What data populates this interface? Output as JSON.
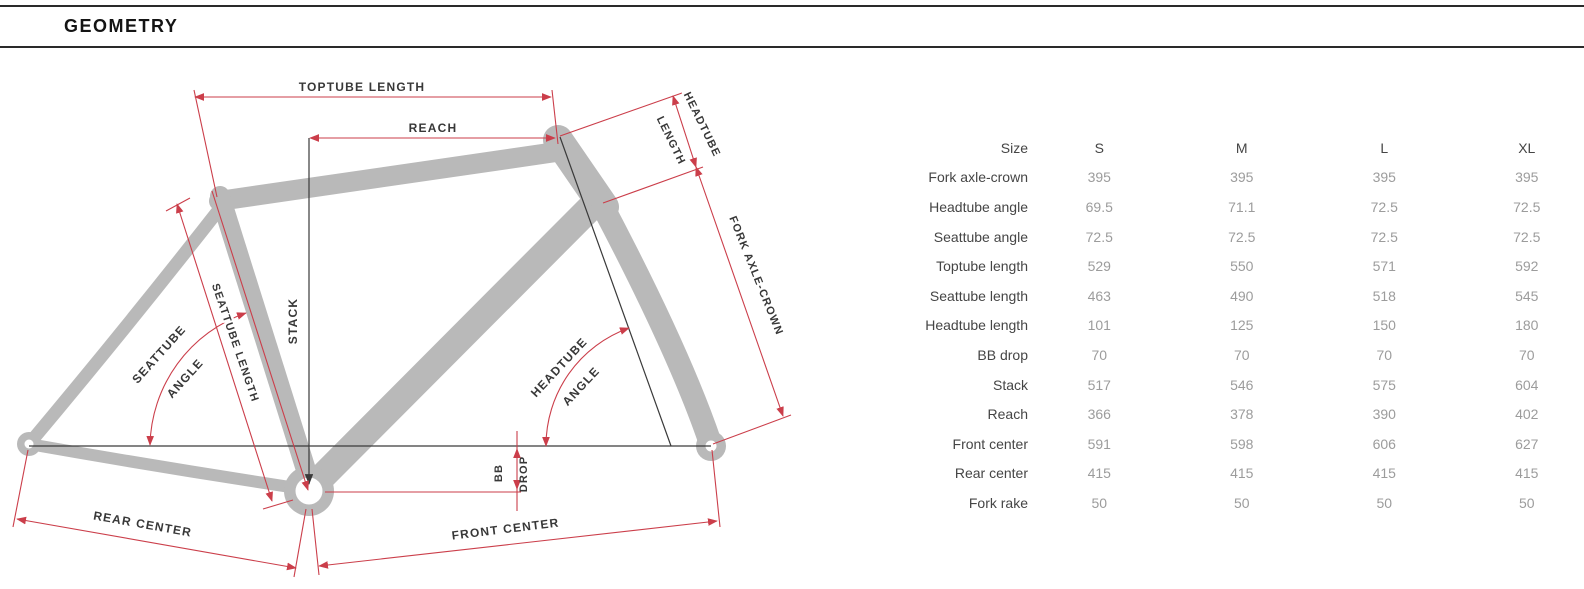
{
  "header": {
    "title": "GEOMETRY"
  },
  "diagram": {
    "labels": {
      "toptube_length": "TOPTUBE LENGTH",
      "reach": "REACH",
      "headtube_len_1": "HEADTUBE",
      "headtube_len_2": "LENGTH",
      "fork_axle_crown": "FORK AXLE-CROWN",
      "seattube_angle_1": "SEATTUBE",
      "seattube_angle_2": "ANGLE",
      "seattube_length": "SEATTUBE LENGTH",
      "stack": "STACK",
      "headtube_angle_1": "HEADTUBE",
      "headtube_angle_2": "ANGLE",
      "bb_drop_1": "BB",
      "bb_drop_2": "DROP",
      "rear_center": "REAR CENTER",
      "front_center": "FRONT CENTER"
    },
    "colors": {
      "dimension_red": "#cb3e4a",
      "frame_gray": "#b9b9b9",
      "line_dark": "#3a3a3a",
      "label_dark": "#383838"
    }
  },
  "table": {
    "size_label": "Size",
    "sizes": [
      "S",
      "M",
      "L",
      "XL"
    ],
    "rows": [
      {
        "label": "Fork axle-crown",
        "values": [
          "395",
          "395",
          "395",
          "395"
        ]
      },
      {
        "label": "Headtube angle",
        "values": [
          "69.5",
          "71.1",
          "72.5",
          "72.5"
        ]
      },
      {
        "label": "Seattube angle",
        "values": [
          "72.5",
          "72.5",
          "72.5",
          "72.5"
        ]
      },
      {
        "label": "Toptube length",
        "values": [
          "529",
          "550",
          "571",
          "592"
        ]
      },
      {
        "label": "Seattube length",
        "values": [
          "463",
          "490",
          "518",
          "545"
        ]
      },
      {
        "label": "Headtube length",
        "values": [
          "101",
          "125",
          "150",
          "180"
        ]
      },
      {
        "label": "BB drop",
        "values": [
          "70",
          "70",
          "70",
          "70"
        ]
      },
      {
        "label": "Stack",
        "values": [
          "517",
          "546",
          "575",
          "604"
        ]
      },
      {
        "label": "Reach",
        "values": [
          "366",
          "378",
          "390",
          "402"
        ]
      },
      {
        "label": "Front center",
        "values": [
          "591",
          "598",
          "606",
          "627"
        ]
      },
      {
        "label": "Rear center",
        "values": [
          "415",
          "415",
          "415",
          "415"
        ]
      },
      {
        "label": "Fork rake",
        "values": [
          "50",
          "50",
          "50",
          "50"
        ]
      }
    ]
  }
}
